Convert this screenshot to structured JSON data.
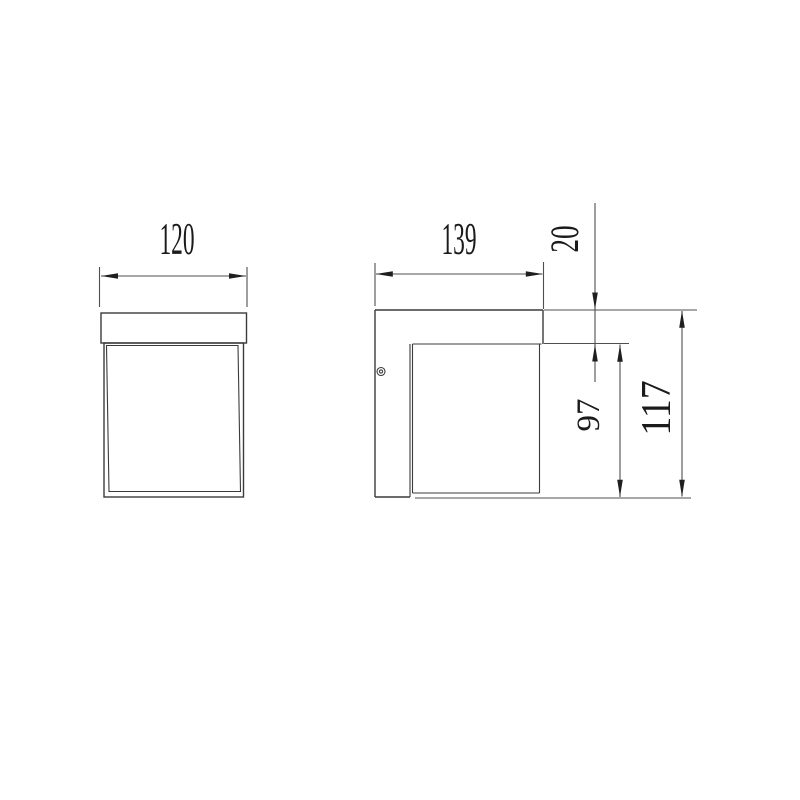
{
  "drawing": {
    "kind": "technical-dimension-drawing",
    "views": {
      "front": {
        "label_width": "120"
      },
      "side": {
        "label_width": "139",
        "label_top_inset": "20",
        "label_body_height": "97",
        "label_total_height": "117"
      }
    }
  },
  "colors": {
    "background": "#ffffff",
    "object_line": "#3b3b3b",
    "dimension_line": "#4f4f4f",
    "text": "#1b1b1b"
  }
}
